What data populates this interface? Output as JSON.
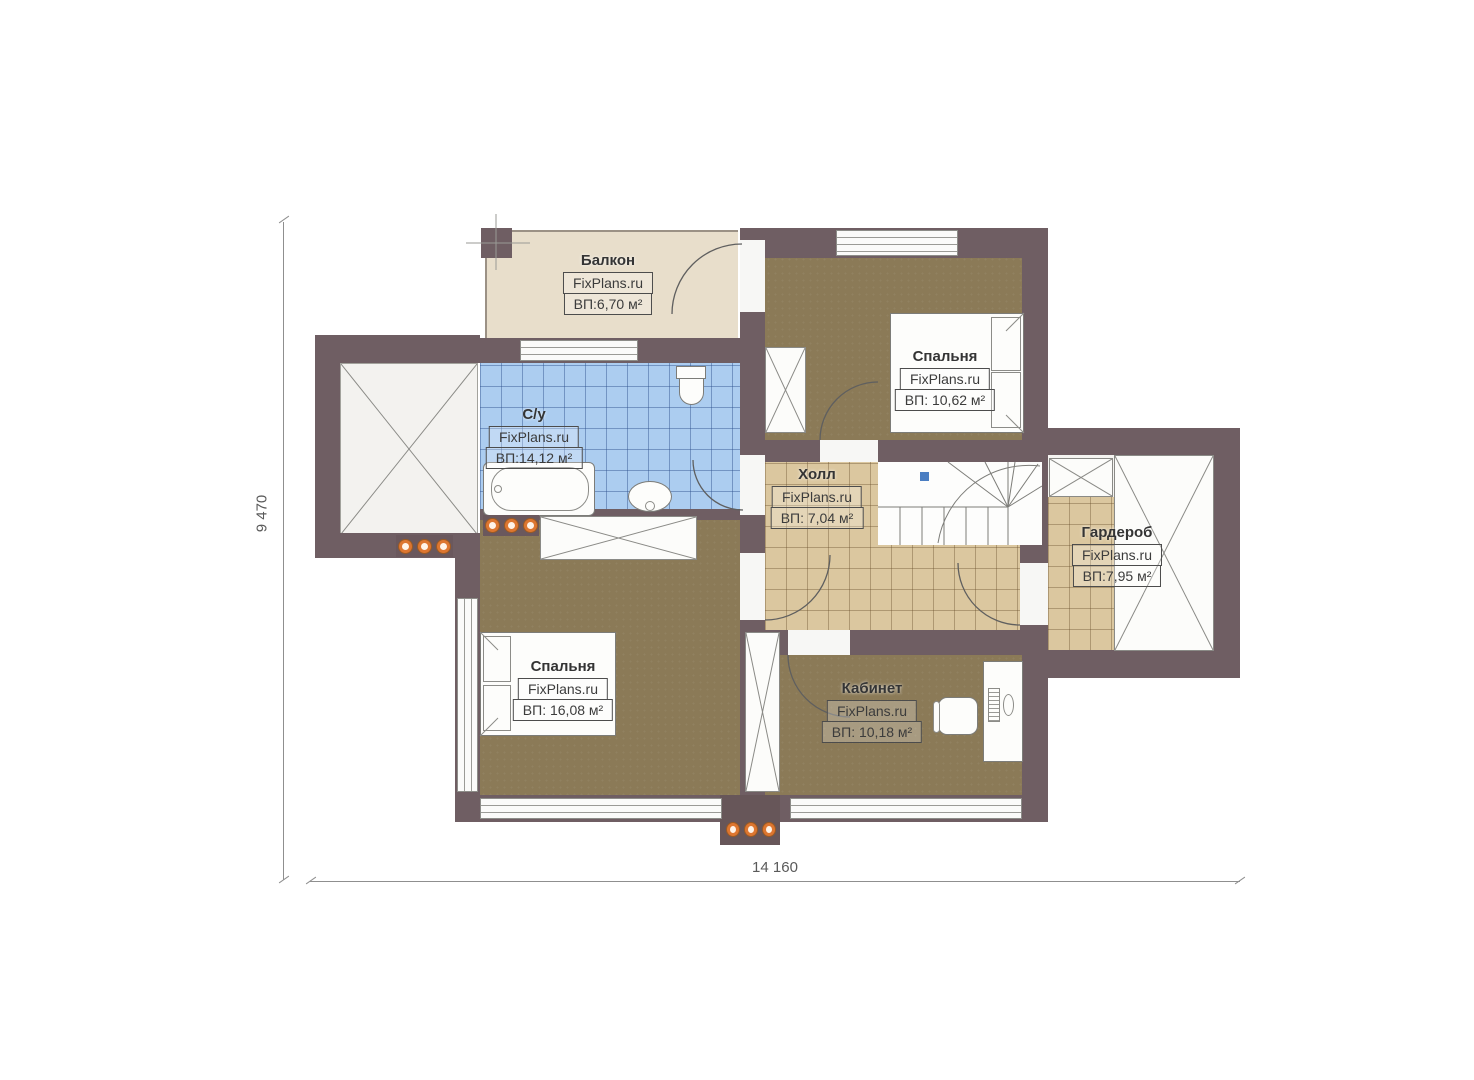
{
  "plan_title": "second-floor-plan",
  "brand": "FixPlans.ru",
  "rooms": {
    "balcony": {
      "name": "Балкон",
      "brand": "FixPlans.ru",
      "area": "ВП:6,70 м²"
    },
    "bedroom_top": {
      "name": "Спальня",
      "brand": "FixPlans.ru",
      "area": "ВП: 10,62 м²"
    },
    "bathroom": {
      "name": "С/у",
      "brand": "FixPlans.ru",
      "area": "ВП:14,12 м²"
    },
    "hall": {
      "name": "Холл",
      "brand": "FixPlans.ru",
      "area": "ВП: 7,04 м²"
    },
    "wardrobe": {
      "name": "Гардероб",
      "brand": "FixPlans.ru",
      "area": "ВП:7,95 м²"
    },
    "bedroom_bottom": {
      "name": "Спальня",
      "brand": "FixPlans.ru",
      "area": "ВП: 16,08 м²"
    },
    "office": {
      "name": "Кабинет",
      "brand": "FixPlans.ru",
      "area": "ВП: 10,18 м²"
    }
  },
  "dimensions": {
    "width_label": "14 160",
    "height_label": "9 470"
  },
  "palette": {
    "wall": "#6f5e63",
    "wood_floor": "#8b7a57",
    "hall_tile": "#dbc79f",
    "bath_tile": "#accdf0",
    "balcony_floor": "#e8decb",
    "vent_dot": "#dd7630",
    "stair_marker": "#4b7ec2"
  }
}
